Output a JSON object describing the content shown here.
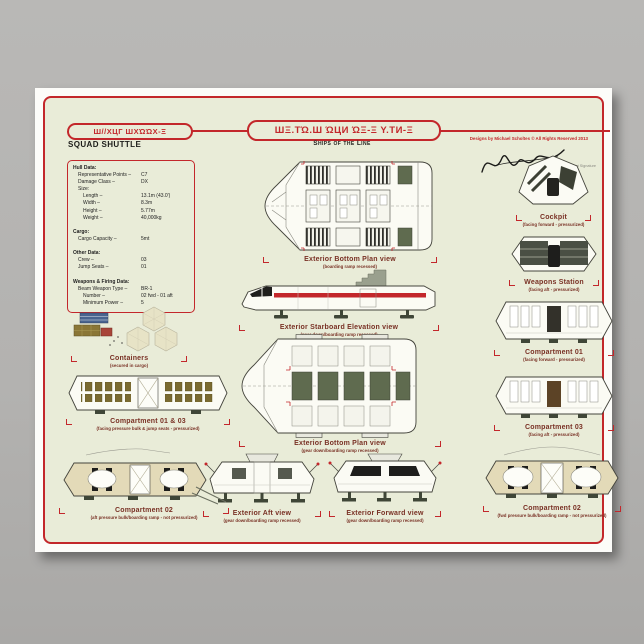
{
  "window": {
    "background": "#b3b2b0"
  },
  "poster": {
    "header": {
      "left_glyphs": "Ш//ХЦГ ШХΏΏХ-Ξ",
      "ship_name": "SQUAD SHUTTLE",
      "series_glyphs": "ШΞ.ТΏ.Ш ΏЦИ ΏΞ-Ξ Υ.ТИ-Ξ",
      "series_subtitle": "Ships of the Line",
      "copyright": "Designs by Michael Scholtes © All Rights Reserved 2013",
      "signature_label": "Artist Signature"
    },
    "spec": {
      "lines": [
        {
          "t": "Hull Data:",
          "b": true
        },
        {
          "t": "Representative Points –",
          "v": "C7",
          "i": 1
        },
        {
          "t": "Damage Class –",
          "v": "DX",
          "i": 1
        },
        {
          "t": "Size:",
          "i": 1
        },
        {
          "t": "Length –",
          "v": "13.1m (43.0')",
          "i": 2
        },
        {
          "t": "Width –",
          "v": "8.3m",
          "i": 2
        },
        {
          "t": "Height –",
          "v": "5.77m",
          "i": 2
        },
        {
          "t": "Weight –",
          "v": "40,000kg",
          "i": 2
        },
        {
          "t": ""
        },
        {
          "t": "Cargo:",
          "b": true
        },
        {
          "t": "Cargo Capacity –",
          "v": "5mt",
          "i": 1
        },
        {
          "t": ""
        },
        {
          "t": "Other Data:",
          "b": true
        },
        {
          "t": "Crew –",
          "v": "03",
          "i": 1
        },
        {
          "t": "Jump Seats –",
          "v": "01",
          "i": 1
        },
        {
          "t": ""
        },
        {
          "t": "Weapons & Firing Data:",
          "b": true
        },
        {
          "t": "Beam Weapon Type –",
          "v": "BR-1",
          "i": 1
        },
        {
          "t": "Number –",
          "v": "02 fwd - 01 aft",
          "i": 2
        },
        {
          "t": "Minimum Power –",
          "v": "5",
          "i": 2
        }
      ]
    },
    "figures": {
      "plan_recessed": {
        "title": "Exterior Bottom Plan view",
        "subtitle": "(boarding ramp recessed)"
      },
      "elevation": {
        "title": "Exterior Starboard Elevation view",
        "subtitle": "(gear down/boarding ramp recessed)"
      },
      "plan_gear": {
        "title": "Exterior Bottom Plan view",
        "subtitle": "(gear down/boarding ramp recessed)"
      },
      "aft": {
        "title": "Exterior Aft view",
        "subtitle": "(gear down/boarding ramp recessed)"
      },
      "forward": {
        "title": "Exterior Forward view",
        "subtitle": "(gear down/boarding ramp recessed)"
      },
      "cockpit": {
        "title": "Cockpit",
        "subtitle": "(facing forward - pressurized)"
      },
      "weapons": {
        "title": "Weapons Station",
        "subtitle": "(facing aft - pressurized)"
      },
      "comp01": {
        "title": "Compartment 01",
        "subtitle": "(facing forward - pressurized)"
      },
      "comp03": {
        "title": "Compartment 03",
        "subtitle": "(facing aft - pressurized)"
      },
      "comp02_right": {
        "title": "Compartment 02",
        "subtitle": "(fwd pressure bulk/boarding ramp - not pressurized)"
      },
      "containers": {
        "title": "Containers",
        "subtitle": "(secured in cargo)"
      },
      "comp0103": {
        "title": "Compartment 01 & 03",
        "subtitle": "(facing pressure bulk & jump seats - pressurized)"
      },
      "comp02_left": {
        "title": "Compartment 02",
        "subtitle": "(aft pressure bulk/boarding ramp - not pressurized)"
      }
    }
  },
  "colors": {
    "accent_red": "#c3272b",
    "caption_red": "#793125",
    "panel_green": "#5f6b4f",
    "hull_tan": "#e3dab8",
    "poster_bg": "#e9ecd8"
  }
}
